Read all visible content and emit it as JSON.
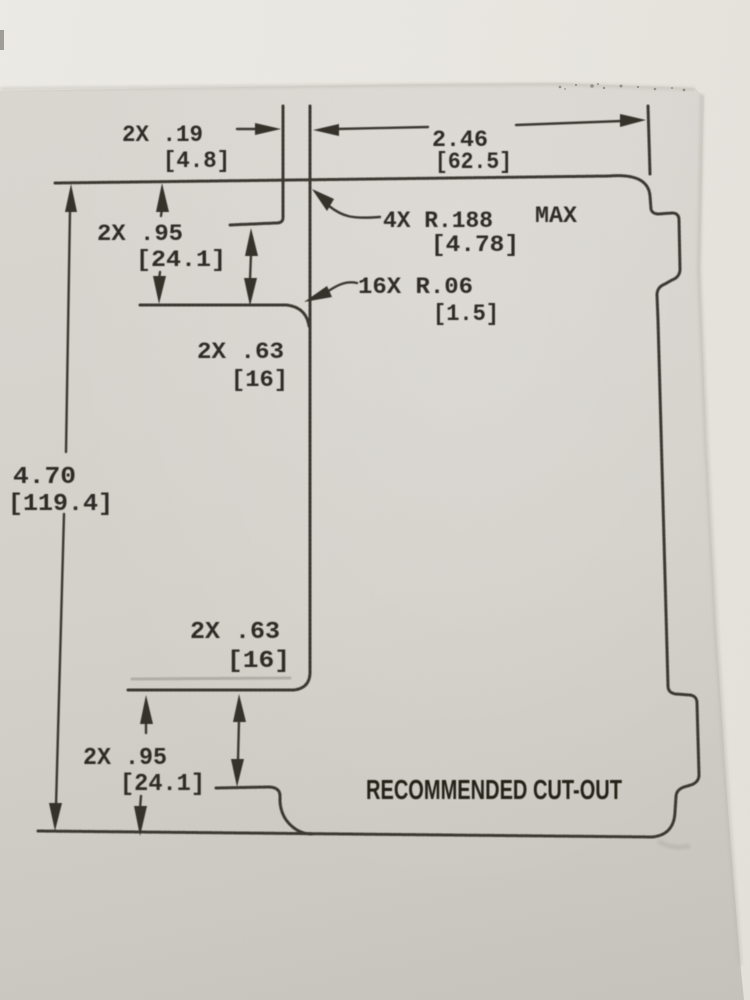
{
  "drawing": {
    "caption": "RECOMMENDED CUT-OUT",
    "dimensions": {
      "slot_width": {
        "inch": "2X .19",
        "mm": "[4.8]"
      },
      "top_width": {
        "inch": "2.46",
        "mm": "[62.5]"
      },
      "corner_radius": {
        "inch": "4X R.188",
        "qualifier": "MAX",
        "mm": "[4.78]"
      },
      "fillet_radius": {
        "inch": "16X R.06",
        "mm": "[1.5]"
      },
      "overall_height": {
        "inch": "4.70",
        "mm": "[119.4]"
      },
      "top_outer_step": {
        "inch": "2X .95",
        "mm": "[24.1]"
      },
      "top_inner_step": {
        "inch": "2X .63",
        "mm": "[16]"
      },
      "bottom_inner_step": {
        "inch": "2X .63",
        "mm": "[16]"
      },
      "bottom_outer_step": {
        "inch": "2X .95",
        "mm": "[24.1]"
      }
    }
  }
}
